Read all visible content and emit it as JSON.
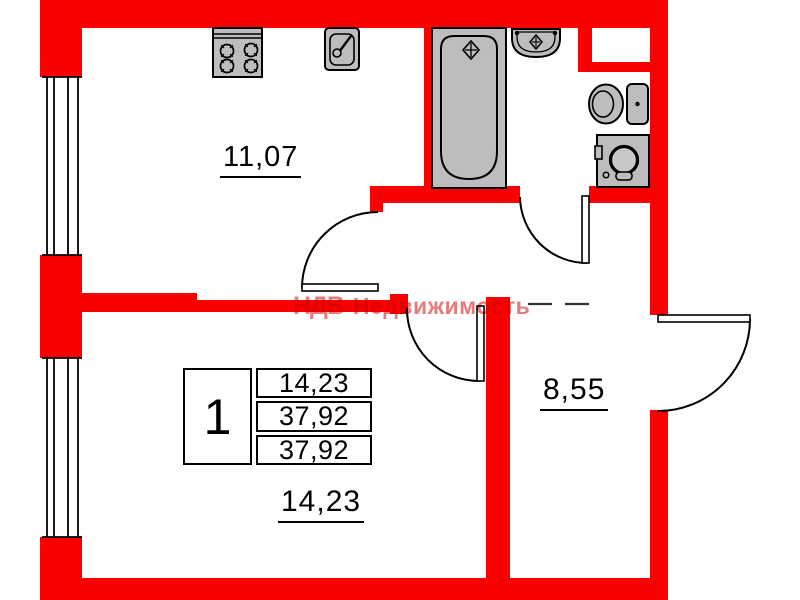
{
  "plan": {
    "watermark": {
      "logo": "НДВ",
      "name": "Недвижимость"
    },
    "rooms": {
      "kitchen": {
        "area": "11,07"
      },
      "living_room": {
        "area": "14,23"
      },
      "hallway": {
        "area": "8,55"
      }
    },
    "info_table": {
      "room_count": "1",
      "rows": [
        "14,23",
        "37,92",
        "37,92"
      ]
    },
    "fixtures": [
      "stove-icon",
      "kitchen-sink-icon",
      "bathtub-icon",
      "washbasin-icon",
      "toilet-icon",
      "washing-machine-icon"
    ],
    "colors": {
      "wall": "#fa0000",
      "fixture": "#bdbdbd",
      "line": "#000000"
    }
  }
}
